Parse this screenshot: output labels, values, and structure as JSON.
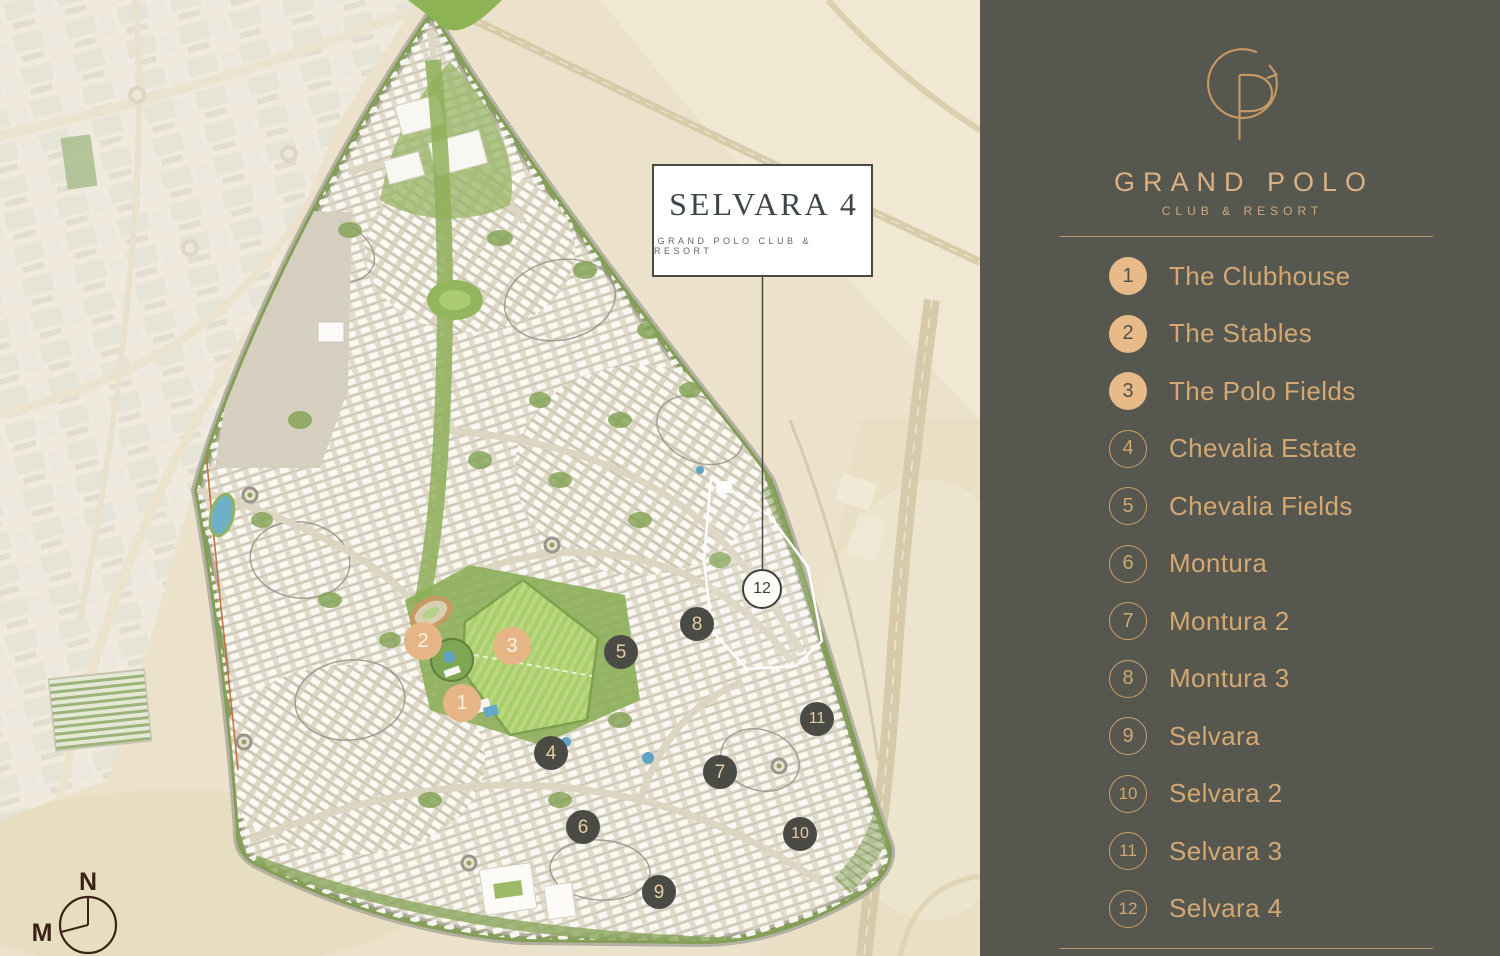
{
  "map": {
    "callout": {
      "title": "SELVARA 4",
      "subtitle": "GRAND POLO CLUB & RESORT"
    },
    "compass": {
      "north_label": "N",
      "m_label": "M"
    },
    "markers": [
      {
        "number": "1",
        "style": "gold",
        "x": 462,
        "y": 703
      },
      {
        "number": "2",
        "style": "gold",
        "x": 423,
        "y": 641
      },
      {
        "number": "3",
        "style": "gold",
        "x": 512,
        "y": 646
      },
      {
        "number": "4",
        "style": "dark",
        "x": 551,
        "y": 753
      },
      {
        "number": "5",
        "style": "dark",
        "x": 621,
        "y": 652
      },
      {
        "number": "6",
        "style": "dark",
        "x": 583,
        "y": 827
      },
      {
        "number": "7",
        "style": "dark",
        "x": 720,
        "y": 772
      },
      {
        "number": "8",
        "style": "dark",
        "x": 697,
        "y": 624
      },
      {
        "number": "9",
        "style": "dark",
        "x": 659,
        "y": 892
      },
      {
        "number": "10",
        "style": "dark",
        "x": 800,
        "y": 834
      },
      {
        "number": "11",
        "style": "dark",
        "x": 817,
        "y": 719
      },
      {
        "number": "12",
        "style": "light",
        "x": 762,
        "y": 589
      }
    ]
  },
  "sidebar": {
    "brand": {
      "monogram": "GP",
      "name": "GRAND POLO",
      "tagline": "CLUB & RESORT"
    },
    "legend": [
      {
        "number": "1",
        "label": "The Clubhouse",
        "filled": true
      },
      {
        "number": "2",
        "label": "The Stables",
        "filled": true
      },
      {
        "number": "3",
        "label": "The Polo Fields",
        "filled": true
      },
      {
        "number": "4",
        "label": "Chevalia Estate",
        "filled": false
      },
      {
        "number": "5",
        "label": "Chevalia Fields",
        "filled": false
      },
      {
        "number": "6",
        "label": "Montura",
        "filled": false
      },
      {
        "number": "7",
        "label": "Montura 2",
        "filled": false
      },
      {
        "number": "8",
        "label": "Montura 3",
        "filled": false
      },
      {
        "number": "9",
        "label": "Selvara",
        "filled": false
      },
      {
        "number": "10",
        "label": "Selvara 2",
        "filled": false
      },
      {
        "number": "11",
        "label": "Selvara 3",
        "filled": false
      },
      {
        "number": "12",
        "label": "Selvara 4",
        "filled": false
      }
    ]
  },
  "colors": {
    "sidebar_bg": "#56574f",
    "accent_gold": "#e2b383",
    "marker_dark": "#4b4b46",
    "legend_text": "#d3a873",
    "field_green": "#a9cc6c",
    "sand": "#ece2cb"
  }
}
